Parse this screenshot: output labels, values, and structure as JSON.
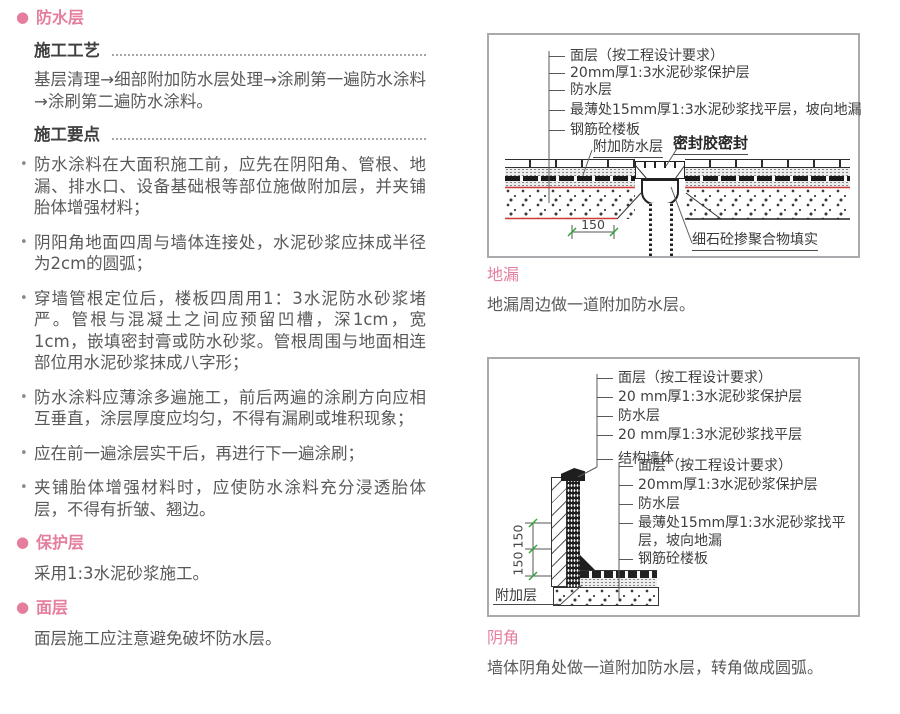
{
  "colors": {
    "accent_pink": "#e57e9d",
    "marker_red": "#d03a3a",
    "dim_tick_green": "#2ea836",
    "frame_gray": "#a8aaad"
  },
  "left": {
    "section1_title": "防水层",
    "process_heading": "施工工艺",
    "process_body": "基层清理→细部附加防水层处理→涂刷第一遍防水涂料→涂刷第二遍防水涂料。",
    "points_heading": "施工要点",
    "points": {
      "items": [
        "防水涂料在大面积施工前，应先在阴阳角、管根、地漏、排水口、设备基础根等部位施做附加层，并夹铺胎体增强材料；",
        "阴阳角地面四周与墙体连接处，水泥砂浆应抹成半径为2cm的圆弧；",
        "穿墙管根定位后，楼板四周用1：3水泥防水砂浆堵严。管根与混凝土之间应预留凹槽，深1cm，宽1cm，嵌填密封膏或防水砂浆。管根周围与地面相连部位用水泥砂浆抹成八字形；",
        "防水涂料应薄涂多遍施工，前后两遍的涂刷方向应相互垂直，涂层厚度应均匀，不得有漏刷或堆积现象；",
        "应在前一遍涂层实干后，再进行下一遍涂刷；",
        "夹铺胎体增强材料时，应使防水涂料充分浸透胎体层，不得有折皱、翘边。"
      ]
    },
    "section2_title": "保护层",
    "section2_body": "采用1:3水泥砂浆施工。",
    "section3_title": "面层",
    "section3_body": "面层施工应注意避免破坏防水层。"
  },
  "right": {
    "figure1": {
      "labels": [
        "面层（按工程设计要求）",
        "20mm厚1:3水泥砂浆保护层",
        "防水层",
        "最薄处15mm厚1:3水泥砂浆找平层，坡向地漏",
        "钢筋砼楼板"
      ],
      "callout_attach": "附加防水层",
      "callout_seal": "密封胶密封",
      "callout_fill": "细石砼掺聚合物填实",
      "dimension": "150",
      "caption_title": "地漏",
      "caption_body": "地漏周边做一道附加防水层。"
    },
    "figure2": {
      "wall_labels": [
        "面层（按工程设计要求）",
        "20 mm厚1:3水泥砂浆保护层",
        "防水层",
        "20 mm厚1:3水泥砂浆找平层",
        "结构墙体"
      ],
      "floor_labels": [
        "面层（按工程设计要求）",
        "20mm厚1:3水泥砂浆保护层",
        "防水层",
        "最薄处15mm厚1:3水泥砂浆找平层，坡向地漏",
        "钢筋砼楼板"
      ],
      "callout_attach": "附加层",
      "dims": [
        "150",
        "150"
      ],
      "caption_title": "阴角",
      "caption_body": "墙体阴角处做一道附加防水层，转角做成圆弧。"
    }
  }
}
